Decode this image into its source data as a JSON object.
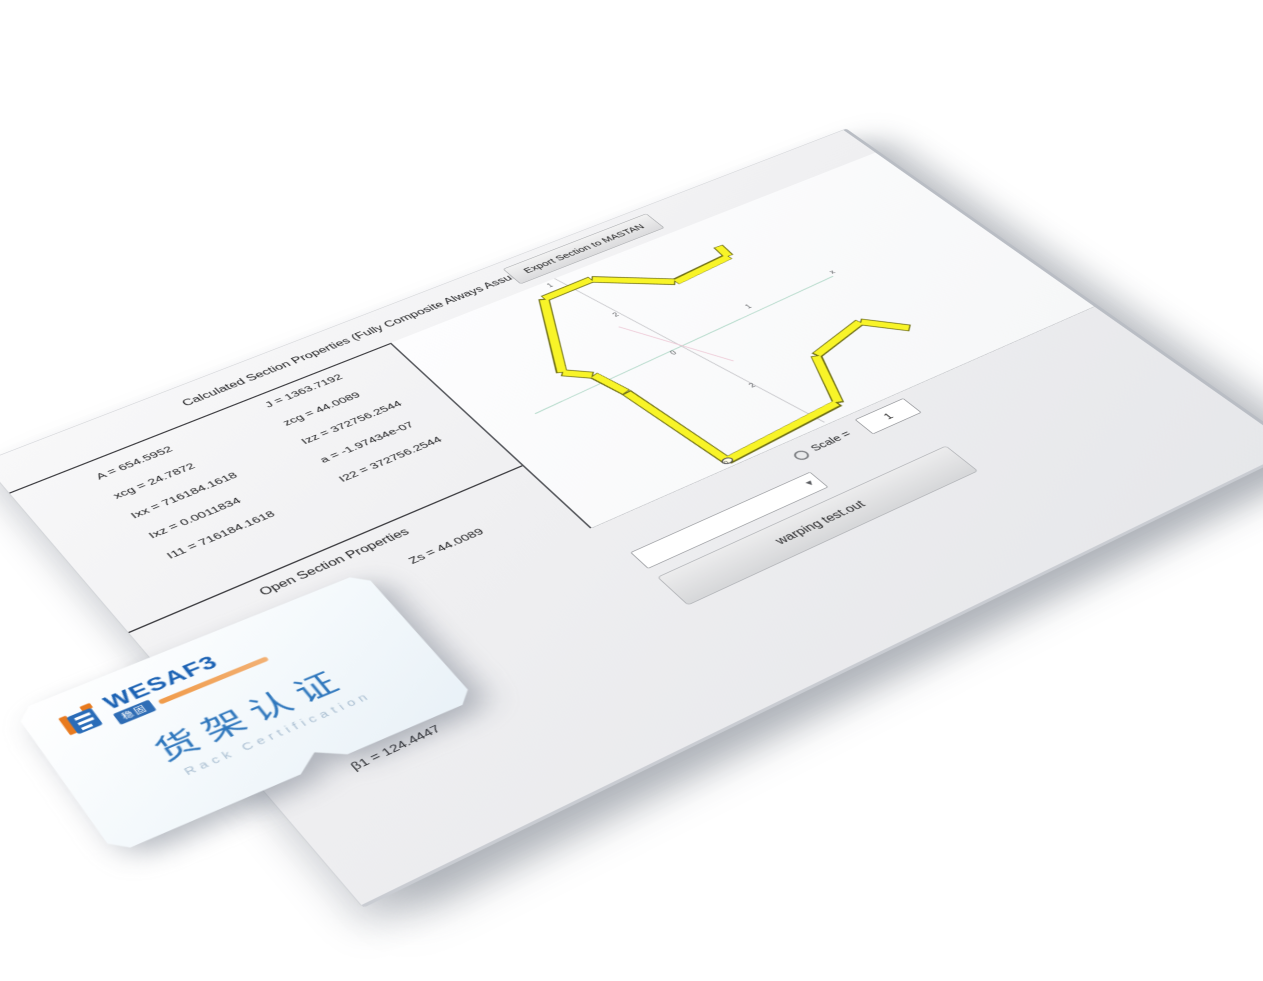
{
  "window": {
    "header": {
      "title": "Calculated Section Properties (Fully Composite Always Assumed)",
      "export_button": "Export Section to MASTAN"
    },
    "calc_properties": {
      "col1": [
        "A = 654.5952",
        "xcg = 24.7872",
        "Ixx = 716184.1618",
        "Ixz = 0.0011834",
        "I11 = 716184.1618"
      ],
      "col2": [
        "J = 1363.7192",
        "zcg = 44.0089",
        "Izz = 372756.2544",
        "a = -1.97434e-07",
        "I22 = 372756.2544"
      ]
    },
    "open_properties": {
      "title": "Open Section Properties",
      "zs": "Zs = 44.0089",
      "beta1": "β1 = 124.4447"
    },
    "controls": {
      "scale_label": "Scale =",
      "scale_value": "1",
      "combo_value": "",
      "file_button": "warping test.out"
    },
    "plot": {
      "section_fill": "#f8f428",
      "section_outline": "#6e6e14",
      "axis_x_color": "#aed7c6",
      "axis_z_color": "#c2c2c6",
      "axis_principal_color": "#edc6d4",
      "ticks": {
        "z_top": "1",
        "z_upper": "2",
        "origin": "0",
        "z_lower": "2",
        "x_tick": "1",
        "x_end": "x"
      },
      "node_label": "0"
    }
  },
  "card": {
    "brand": "WESAF3",
    "badge": "稳固",
    "title_zh": "货架认证",
    "subtitle": "Rack Certification",
    "brand_blue": "#1b62b4",
    "brand_orange": "#e87a1e"
  }
}
